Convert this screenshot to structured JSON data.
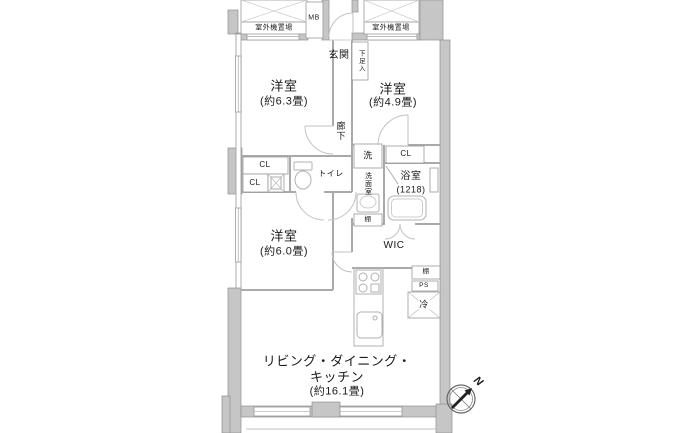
{
  "floorplan": {
    "rooms": {
      "bedroom1": {
        "name": "洋室",
        "size": "(約6.3畳)"
      },
      "bedroom2": {
        "name": "洋室",
        "size": "(約4.9畳)"
      },
      "bedroom3": {
        "name": "洋室",
        "size": "(約6.0畳)"
      },
      "ldk": {
        "line1": "リビング・ダイニング・",
        "line2": "キッチン",
        "size": "(約16.1畳)"
      },
      "entrance": "玄関",
      "hallway": "廊下",
      "washroom": "洗面室",
      "bathroom": {
        "name": "浴室",
        "size": "(1218)"
      },
      "toilet": "トイレ",
      "wic": "WIC"
    },
    "labels": {
      "outdoor_unit": "室外機置場",
      "meter_box": "MB",
      "shoe_box": "下足入",
      "washer": "洗",
      "closet": "CL",
      "shelf": "棚",
      "pipe_space": "PS",
      "refrigerator": "冷",
      "compass_north": "N"
    },
    "colors": {
      "wall_fill": "#c6c6c6",
      "wall_edge": "#8f8f8f",
      "partition_line": "#a9a9a9",
      "fixture_line": "#b0b0b0",
      "text": "#1a1a1a"
    }
  }
}
